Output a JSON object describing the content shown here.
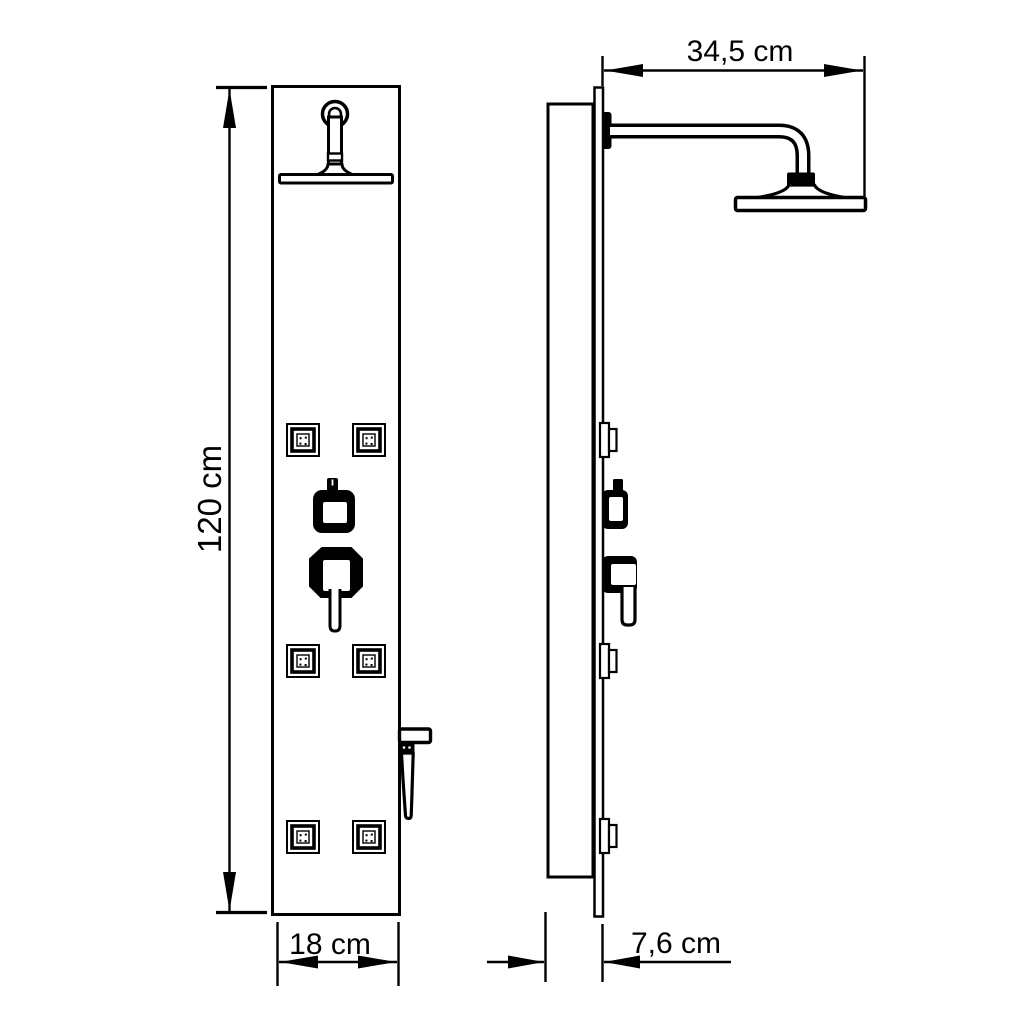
{
  "colors": {
    "line": "#000000",
    "background": "#ffffff"
  },
  "dimension_labels": {
    "height": "120 cm",
    "width": "18 cm",
    "arm_reach": "34,5 cm",
    "depth": "7,6 cm"
  }
}
